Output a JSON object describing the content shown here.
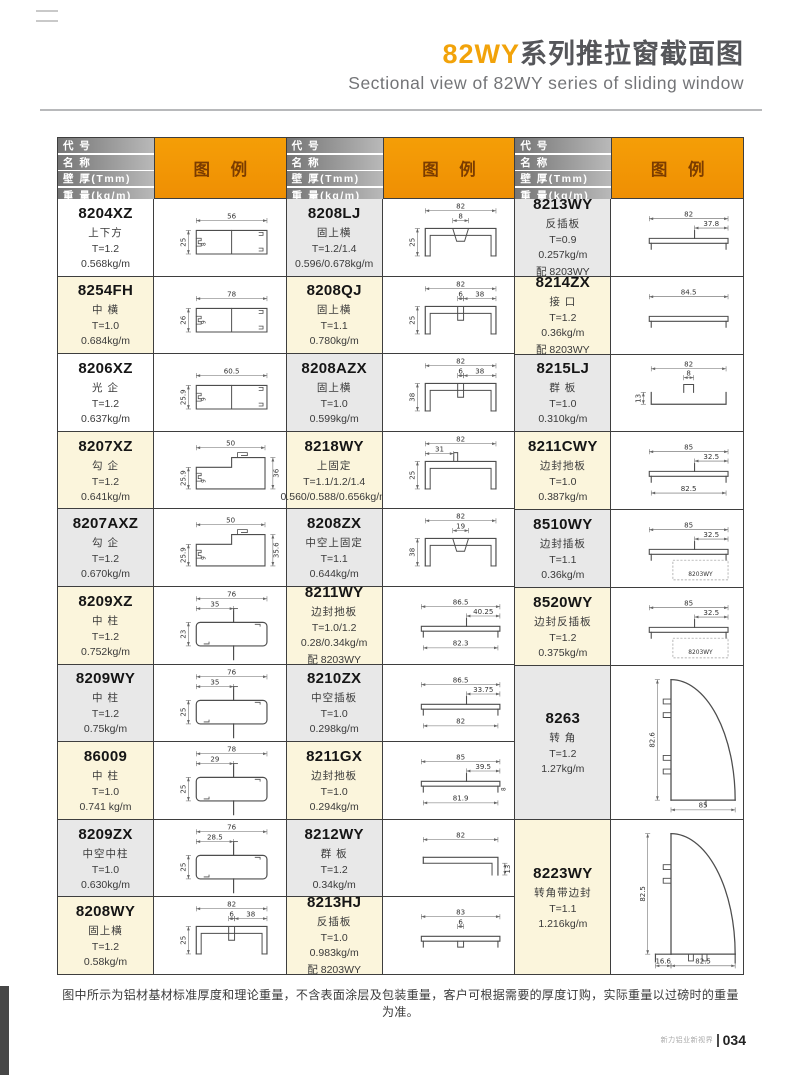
{
  "page": {
    "title_highlight": "82WY",
    "title_rest": "系列推拉窗截面图",
    "subtitle": "Sectional view of 82WY series of sliding window",
    "footnote": "图中所示为铝材基材标准厚度和理论重量，不含表面涂层及包装重量，客户可根据需要的厚度订购，实际重量以过磅时的重量为准。",
    "brand": "新力铝业新视界",
    "page_number": "034",
    "colors": {
      "accent_orange": "#F29104",
      "row_cream": "#FBF5DC",
      "row_gray": "#E8E8E8",
      "header_gray": "#8a8a8a"
    }
  },
  "table": {
    "header": {
      "rows": [
        "代 号",
        "名 称",
        "壁 厚(Tmm)",
        "重 量(kg/m)"
      ],
      "legend": "图 例"
    },
    "columns": [
      {
        "rows": [
          {
            "code": "8204XZ",
            "name": "上下方",
            "thickness": "T=1.2",
            "weight": "0.568kg/m",
            "extra": "",
            "tone": "white",
            "diagram": {
              "shape": "box",
              "top": "56",
              "left": "25",
              "left2": "8"
            }
          },
          {
            "code": "8254FH",
            "name": "中 横",
            "thickness": "T=1.0",
            "weight": "0.684kg/m",
            "extra": "",
            "tone": "cream",
            "diagram": {
              "shape": "box",
              "top": "78",
              "left": "26",
              "left2": "9"
            }
          },
          {
            "code": "8206XZ",
            "name": "光 企",
            "thickness": "T=1.2",
            "weight": "0.637kg/m",
            "extra": "",
            "tone": "white",
            "diagram": {
              "shape": "box",
              "top": "60.5",
              "left": "25.9",
              "left2": "9"
            }
          },
          {
            "code": "8207XZ",
            "name": "勾 企",
            "thickness": "T=1.2",
            "weight": "0.641kg/m",
            "extra": "",
            "tone": "cream",
            "diagram": {
              "shape": "hook",
              "top": "50",
              "left": "25.9",
              "left2": "9",
              "right": "36"
            }
          },
          {
            "code": "8207AXZ",
            "name": "勾 企",
            "thickness": "T=1.2",
            "weight": "0.670kg/m",
            "extra": "",
            "tone": "gray",
            "diagram": {
              "shape": "hook",
              "top": "50",
              "left": "25.9",
              "left2": "9",
              "right": "35.6"
            }
          },
          {
            "code": "8209XZ",
            "name": "中 柱",
            "thickness": "T=1.2",
            "weight": "0.752kg/m",
            "extra": "",
            "tone": "cream",
            "diagram": {
              "shape": "rail",
              "top": "76",
              "top2": "35",
              "left": "23"
            }
          },
          {
            "code": "8209WY",
            "name": "中 柱",
            "thickness": "T=1.2",
            "weight": "0.75kg/m",
            "extra": "",
            "tone": "gray",
            "diagram": {
              "shape": "rail",
              "top": "76",
              "top2": "35",
              "left": "25"
            }
          },
          {
            "code": "86009",
            "name": "中 柱",
            "thickness": "T=1.0",
            "weight": "0.741 kg/m",
            "extra": "",
            "tone": "cream",
            "diagram": {
              "shape": "rail",
              "top": "78",
              "top2": "29",
              "left": "25"
            }
          },
          {
            "code": "8209ZX",
            "name": "中空中柱",
            "thickness": "T=1.0",
            "weight": "0.630kg/m",
            "extra": "",
            "tone": "gray",
            "diagram": {
              "shape": "rail",
              "top": "76",
              "top2": "28.5",
              "left": "25"
            }
          },
          {
            "code": "8208WY",
            "name": "固上横",
            "thickness": "T=1.2",
            "weight": "0.58kg/m",
            "extra": "",
            "tone": "cream",
            "diagram": {
              "shape": "chan",
              "center": "tab",
              "top": "82",
              "mid": "6",
              "mid2": "38",
              "left": "25"
            }
          }
        ]
      },
      {
        "rows": [
          {
            "code": "8208LJ",
            "name": "固上横",
            "thickness": "T=1.2/1.4",
            "weight": "0.596/0.678kg/m",
            "extra": "",
            "tone": "gray",
            "diagram": {
              "shape": "chan",
              "center": "trap",
              "top": "82",
              "mid": "8",
              "left": "25"
            }
          },
          {
            "code": "8208QJ",
            "name": "固上横",
            "thickness": "T=1.1",
            "weight": "0.780kg/m",
            "extra": "",
            "tone": "cream",
            "diagram": {
              "shape": "chan",
              "center": "tab",
              "top": "82",
              "mid": "6",
              "mid2": "38",
              "left": "25"
            }
          },
          {
            "code": "8208AZX",
            "name": "固上横",
            "thickness": "T=1.0",
            "weight": "0.599kg/m",
            "extra": "",
            "tone": "gray",
            "diagram": {
              "shape": "chan",
              "center": "tab",
              "top": "82",
              "mid": "6",
              "mid2": "38",
              "left": "38"
            }
          },
          {
            "code": "8218WY",
            "name": "上固定",
            "thickness": "T=1.1/1.2/1.4",
            "weight": "0.560/0.588/0.656kg/m",
            "extra": "",
            "tone": "cream",
            "diagram": {
              "shape": "chan",
              "center": "uptab",
              "top": "82",
              "top2": "31",
              "left": "25"
            }
          },
          {
            "code": "8208ZX",
            "name": "中空上固定",
            "thickness": "T=1.1",
            "weight": "0.644kg/m",
            "extra": "",
            "tone": "gray",
            "diagram": {
              "shape": "chan",
              "center": "trap",
              "top": "82",
              "mid": "19",
              "left": "38"
            }
          },
          {
            "code": "8211WY",
            "name": "边封扡板",
            "thickness": "T=1.0/1.2",
            "weight": "0.28/0.34kg/m",
            "extra": "配 8203WY",
            "tone": "cream",
            "diagram": {
              "shape": "flat",
              "top": "86.5",
              "top2": "40.25",
              "bottom": "82.3"
            }
          },
          {
            "code": "8210ZX",
            "name": "中空插板",
            "thickness": "T=1.0",
            "weight": "0.298kg/m",
            "extra": "",
            "tone": "gray",
            "diagram": {
              "shape": "flat",
              "top": "86.5",
              "top2": "33.75",
              "bottom": "82"
            }
          },
          {
            "code": "8211GX",
            "name": "边封扡板",
            "thickness": "T=1.0",
            "weight": "0.294kg/m",
            "extra": "",
            "tone": "cream",
            "diagram": {
              "shape": "flat",
              "top": "85",
              "top2": "39.5",
              "bottom": "81.9",
              "right": "8"
            }
          },
          {
            "code": "8212WY",
            "name": "群 板",
            "thickness": "T=1.2",
            "weight": "0.34kg/m",
            "extra": "",
            "tone": "gray",
            "diagram": {
              "shape": "angle",
              "top": "82",
              "right": "13"
            }
          },
          {
            "code": "8213HJ",
            "name": "反插板",
            "thickness": "T=1.0",
            "weight": "0.983kg/m",
            "extra": "配 8203WY",
            "tone": "cream",
            "diagram": {
              "shape": "flat",
              "top": "83",
              "mid": "6",
              "notch": true
            }
          }
        ]
      },
      {
        "rows": [
          {
            "code": "8213WY",
            "name": "反插板",
            "thickness": "T=0.9",
            "weight": "0.257kg/m",
            "extra": "配 8203WY",
            "tone": "gray",
            "diagram": {
              "shape": "flat",
              "top": "82",
              "top2": "37.8"
            }
          },
          {
            "code": "8214ZX",
            "name": "接 口",
            "thickness": "T=1.2",
            "weight": "0.36kg/m",
            "extra": "配 8203WY",
            "tone": "cream",
            "diagram": {
              "shape": "flat",
              "top": "84.5"
            }
          },
          {
            "code": "8215LJ",
            "name": "群 板",
            "thickness": "T=1.0",
            "weight": "0.310kg/m",
            "extra": "",
            "tone": "gray",
            "diagram": {
              "shape": "tray",
              "top": "82",
              "mid": "8",
              "left": "13"
            }
          },
          {
            "code": "8211CWY",
            "name": "边封扡板",
            "thickness": "T=1.0",
            "weight": "0.387kg/m",
            "extra": "",
            "tone": "cream",
            "diagram": {
              "shape": "flat",
              "top": "85",
              "top2": "32.5",
              "bottom": "82.5"
            }
          },
          {
            "code": "8510WY",
            "name": "边封插板",
            "thickness": "T=1.1",
            "weight": "0.36kg/m",
            "extra": "",
            "tone": "gray",
            "diagram": {
              "shape": "flat",
              "top": "85",
              "top2": "32.5",
              "sub": "8203WY"
            }
          },
          {
            "code": "8520WY",
            "name": "边封反插板",
            "thickness": "T=1.2",
            "weight": "0.375kg/m",
            "extra": "",
            "tone": "cream",
            "diagram": {
              "shape": "flat",
              "top": "85",
              "top2": "32.5",
              "sub": "8203WY"
            }
          },
          {
            "code": "8263",
            "name": "转 角",
            "thickness": "T=1.2",
            "weight": "1.27kg/m",
            "extra": "",
            "tone": "gray",
            "tall": true,
            "diagram": {
              "shape": "corner",
              "left": "82.6",
              "bottom": "85",
              "hooks": 4
            }
          },
          {
            "code": "8223WY",
            "name": "转角带边封",
            "thickness": "T=1.1",
            "weight": "1.216kg/m",
            "extra": "",
            "tone": "cream",
            "tall": true,
            "diagram": {
              "shape": "corner",
              "left": "82.5",
              "bottom": "82.5",
              "bottom2": "16.6",
              "hooks": 2,
              "feet": true
            }
          }
        ]
      }
    ]
  }
}
